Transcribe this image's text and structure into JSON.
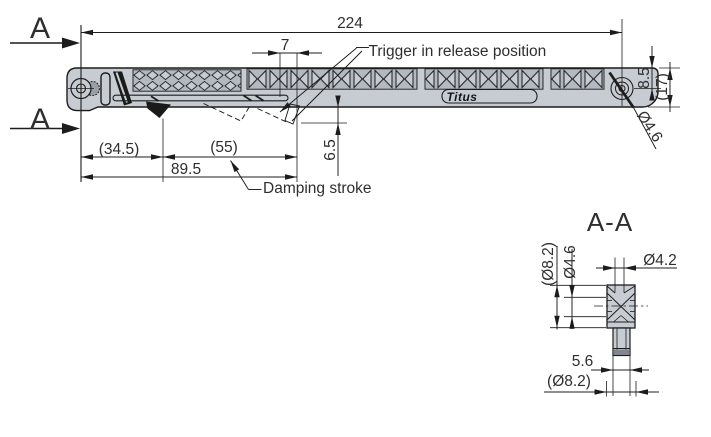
{
  "colors": {
    "background": "#ffffff",
    "body-fill": "#c7ccd2",
    "band-fill": "#b3b9c1",
    "line": "#1c1c1c",
    "text": "#2e2e2e",
    "dark-fill": "#1a1a1a"
  },
  "main_view": {
    "section_marker": "A",
    "logo": "Titus",
    "dims": {
      "overall": "224",
      "trigger_offset": "7",
      "front": "(34.5)",
      "stroke": "(55)",
      "total_stroke": "89.5",
      "drop": "6.5",
      "height_half": "8.5",
      "height_total": "(17)",
      "hole_dia": "Ø4.6"
    },
    "labels": {
      "trigger": "Trigger in release position",
      "damping": "Damping stroke"
    }
  },
  "section_view": {
    "title": "A-A",
    "dims": {
      "bush_ref": "(Ø8.2)",
      "pin_dia": "Ø4.6",
      "hole_dia": "Ø4.2",
      "stem": "5.6",
      "flange_ref": "(Ø8.2)"
    }
  }
}
